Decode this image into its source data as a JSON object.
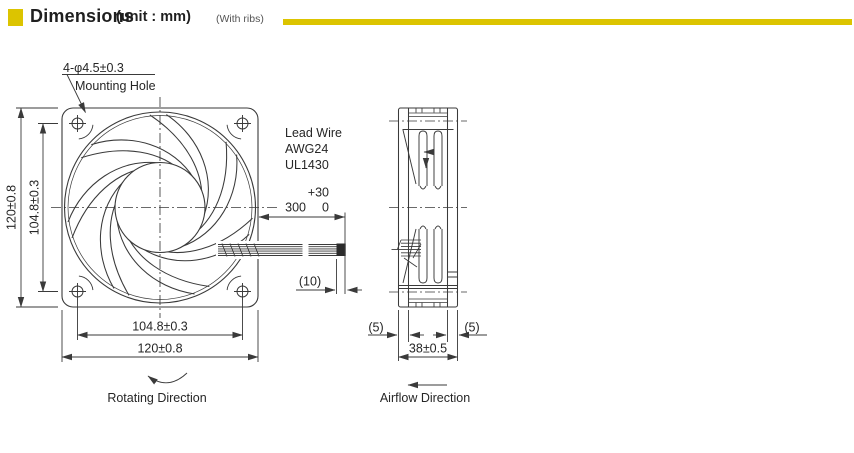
{
  "header": {
    "title": "Dimensions",
    "unit": "(unit : mm)",
    "note": "(With ribs)",
    "accent_color": "#DCC400"
  },
  "front_view": {
    "mounting_hole_callout": {
      "line1": "4-φ4.5±0.3",
      "line2": "Mounting Hole"
    },
    "dims": {
      "height_outer": "120±0.8",
      "height_inner": "104.8±0.3",
      "width_inner": "104.8±0.3",
      "width_outer": "120±0.8"
    },
    "rotating_direction_label": "Rotating Direction"
  },
  "lead_wire": {
    "label1": "Lead Wire",
    "label2": "AWG24",
    "label3": "UL1430",
    "tol_upper": "+30",
    "length": "300",
    "tol_lower": "0",
    "strip_length": "(10)"
  },
  "side_view": {
    "dims": {
      "rib_left": "(5)",
      "rib_right": "(5)",
      "depth": "38±0.5"
    },
    "airflow_direction_label": "Airflow Direction"
  },
  "line_color": "#3A3A3A"
}
